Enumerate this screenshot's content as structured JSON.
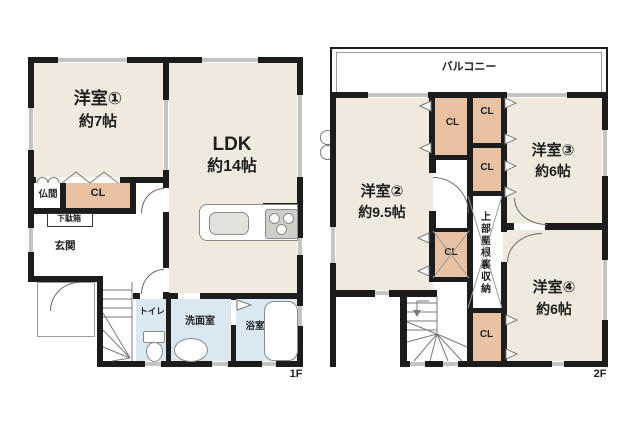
{
  "floor1": {
    "label": "1F",
    "rooms": {
      "western1": {
        "name": "洋室①",
        "area": "約7帖"
      },
      "ldk": {
        "name": "LDK",
        "area": "約14帖"
      },
      "butsuma": {
        "name": "仏間"
      },
      "closet": {
        "name": "CL"
      },
      "shoe_cabinet": {
        "name": "下駄箱"
      },
      "entrance": {
        "name": "玄関"
      },
      "toilet": {
        "name": "トイレ"
      },
      "washroom": {
        "name": "洗面室"
      },
      "bathroom": {
        "name": "浴室"
      }
    }
  },
  "floor2": {
    "label": "2F",
    "balcony": {
      "name": "バルコニー"
    },
    "rooms": {
      "western2": {
        "name": "洋室②",
        "area": "約9.5帖"
      },
      "western3": {
        "name": "洋室③",
        "area": "約6帖"
      },
      "western4": {
        "name": "洋室④",
        "area": "約6帖"
      },
      "closet": {
        "name": "CL"
      },
      "attic_storage": {
        "name": "上部屋根裏収納"
      }
    }
  },
  "colors": {
    "wall": "#1c1c1c",
    "room_fill": "#efe9de",
    "closet_fill": "#e8c2a2",
    "wet_area_fill": "#d9e8f1",
    "detail_line": "#8a8a8a",
    "text": "#1f1f1f"
  }
}
